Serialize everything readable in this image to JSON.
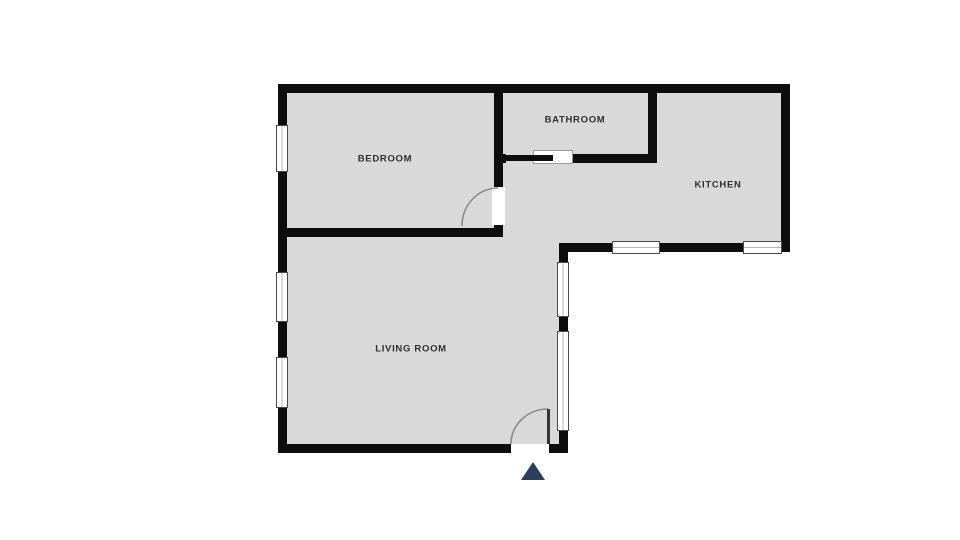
{
  "rooms": [
    {
      "id": "bedroom",
      "label": "BEDROOM"
    },
    {
      "id": "bathroom",
      "label": "BATHROOM"
    },
    {
      "id": "kitchen",
      "label": "KITCHEN"
    },
    {
      "id": "living_room",
      "label": "LIVING ROOM"
    }
  ],
  "icons": {
    "entrance_marker": "triangle-up"
  },
  "colors": {
    "background": "#ffffff",
    "room_fill": "#d9d9d9",
    "wall": "#0d0d0d",
    "window_frame": "#4a4a4a",
    "door_arc": "#8a8a8a",
    "entrance_marker": "#2b3e5b",
    "label_text": "#2f2f2f"
  }
}
